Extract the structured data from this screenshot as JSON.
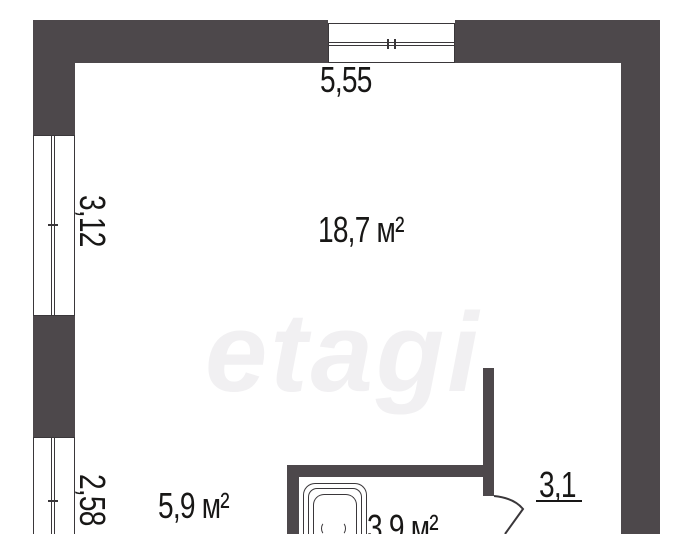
{
  "colors": {
    "bg": "#ffffff",
    "wall": "#4d484b",
    "line": "#3a373a",
    "text": "#181716",
    "watermark": "#f1f0f2"
  },
  "watermark": {
    "text": "etagi"
  },
  "labels": {
    "top_width": "5,55",
    "left_height_upper": "3,12",
    "left_height_lower": "2,58",
    "main_room_area": "18,7 м²",
    "kitchen_area": "5,9 м²",
    "bath_area": "3,9 м²",
    "hall_width": "3,1"
  }
}
